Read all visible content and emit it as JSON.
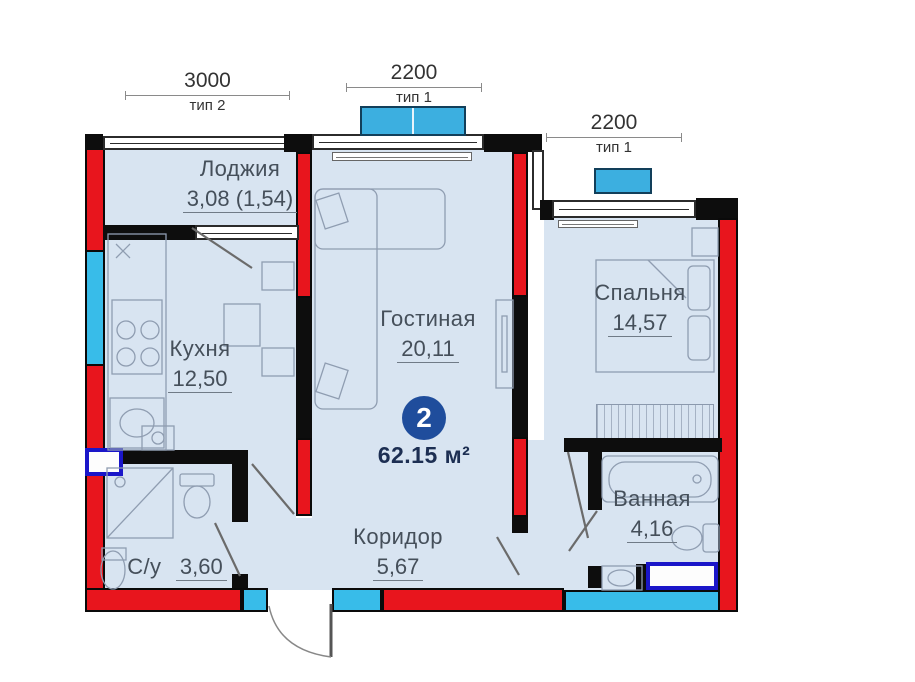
{
  "plan": {
    "badge": {
      "rooms_count": "2",
      "total_area": "62.15 м²"
    },
    "rooms": [
      {
        "id": "loggia",
        "name": "Лоджия",
        "area": "3,08 (1,54)"
      },
      {
        "id": "kitchen",
        "name": "Кухня",
        "area": "12,50"
      },
      {
        "id": "living",
        "name": "Гостиная",
        "area": "20,11"
      },
      {
        "id": "bedroom",
        "name": "Спальня",
        "area": "14,57"
      },
      {
        "id": "bathroom",
        "name": "Ванная",
        "area": "4,16"
      },
      {
        "id": "wc",
        "name": "С/у",
        "area": "3,60"
      },
      {
        "id": "corridor",
        "name": "Коридор",
        "area": "5,67"
      }
    ],
    "dimensions": [
      {
        "value": "3000",
        "type": "тип 2"
      },
      {
        "value": "2200",
        "type": "тип 1"
      },
      {
        "value": "2200",
        "type": "тип 1"
      }
    ],
    "colors": {
      "wall_red": "#e8151d",
      "wall_black": "#0d0d0d",
      "window_cyan": "#38bce9",
      "balcony_blue": "#3cafe0",
      "plumbing_navy": "#1a16c9",
      "room_fill": "#d8e4f1",
      "badge_blue": "#1f4d9c",
      "total_navy": "#1c2e52"
    },
    "fixtures": [
      "balcony-window-unit",
      "loggia-door",
      "kitchen-counter",
      "stove",
      "kitchen-sink",
      "water-heater",
      "dining-table",
      "chair",
      "sofa",
      "tv-stand",
      "bed",
      "nightstand",
      "wardrobe",
      "bathtub",
      "toilet",
      "bathroom-sink",
      "washing-machine",
      "shower",
      "entry-door"
    ]
  }
}
